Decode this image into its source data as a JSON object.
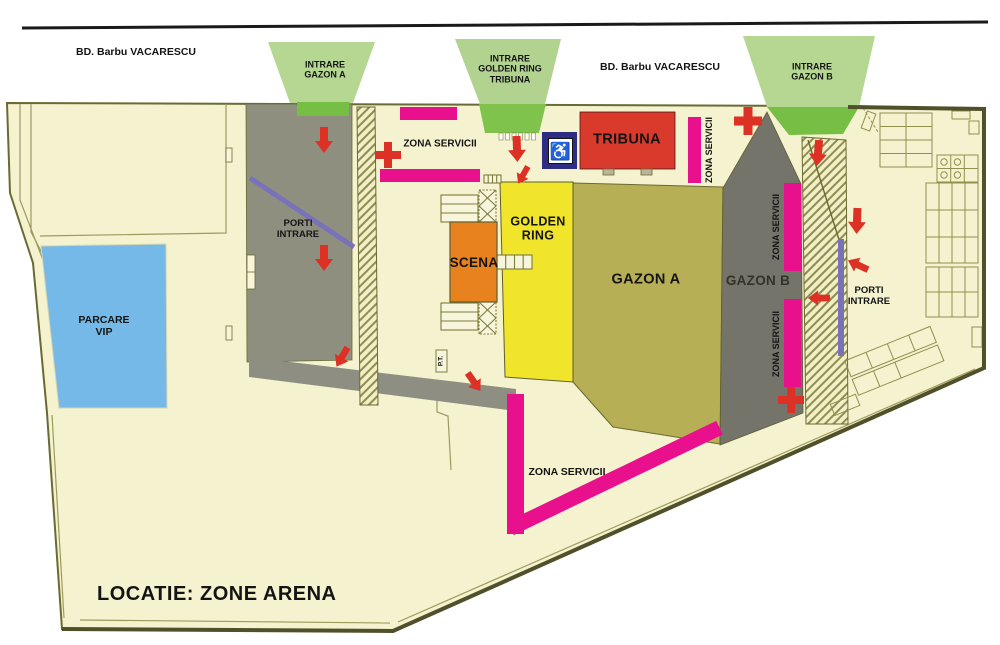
{
  "map_title": "LOCATIE: ZONE ARENA",
  "streets": {
    "left_label": "BD. Barbu VACARESCU",
    "right_label": "BD. Barbu VACARESCU"
  },
  "entrances": {
    "gazon_a": {
      "line1": "INTRARE",
      "line2": "GAZON A"
    },
    "golden_ring_tribuna": {
      "line1": "INTRARE",
      "line2": "GOLDEN RING",
      "line3": "TRIBUNA"
    },
    "gazon_b": {
      "line1": "INTRARE",
      "line2": "GAZON B"
    }
  },
  "areas": {
    "parcare_vip": {
      "line1": "PARCARE",
      "line2": "VIP"
    },
    "scena": {
      "label": "SCENA"
    },
    "golden_ring": {
      "line1": "GOLDEN",
      "line2": "RING"
    },
    "gazon_a": {
      "label": "GAZON A"
    },
    "gazon_b": {
      "label": "GAZON B"
    },
    "tribuna": {
      "label": "TRIBUNA"
    }
  },
  "gates": {
    "porti_left": {
      "line1": "PORTI",
      "line2": "INTRARE"
    },
    "porti_right": {
      "line1": "PORTI",
      "line2": "INTRARE"
    }
  },
  "service_zones": {
    "top": "ZONA SERVICII",
    "tribuna_side": "ZONA SERVICII",
    "gazon_b_upper": "ZONA SERVICII",
    "gazon_b_lower": "ZONA SERVICII",
    "bottom": "ZONA SERVICII"
  },
  "small_labels": {
    "pt": "P.T."
  },
  "icons": {
    "wheelchair_glyph": "♿",
    "first_aid": "first-aid-cross",
    "flow_arrow": "red-flow-arrow"
  },
  "colors": {
    "site_cream": "#f5f2cf",
    "outline_olive": "#6a6a33",
    "boundary_dark": "#50502a",
    "entrance_green_light": "#b5d791",
    "entrance_green_dark": "#77bf44",
    "service_magenta": "#e8108c",
    "alert_red": "#dd3126",
    "tribuna_red": "#d93a2c",
    "scena_orange": "#e8821f",
    "golden_ring_yellow": "#f0e52b",
    "gazon_a_olive": "#b6af55",
    "corridor_gray": "#8f8f80",
    "gazon_b_gray": "#74746a",
    "parcare_blue": "#74b9e7",
    "gate_purple": "#7a72b8",
    "handicap_navy": "#2d2e83"
  }
}
